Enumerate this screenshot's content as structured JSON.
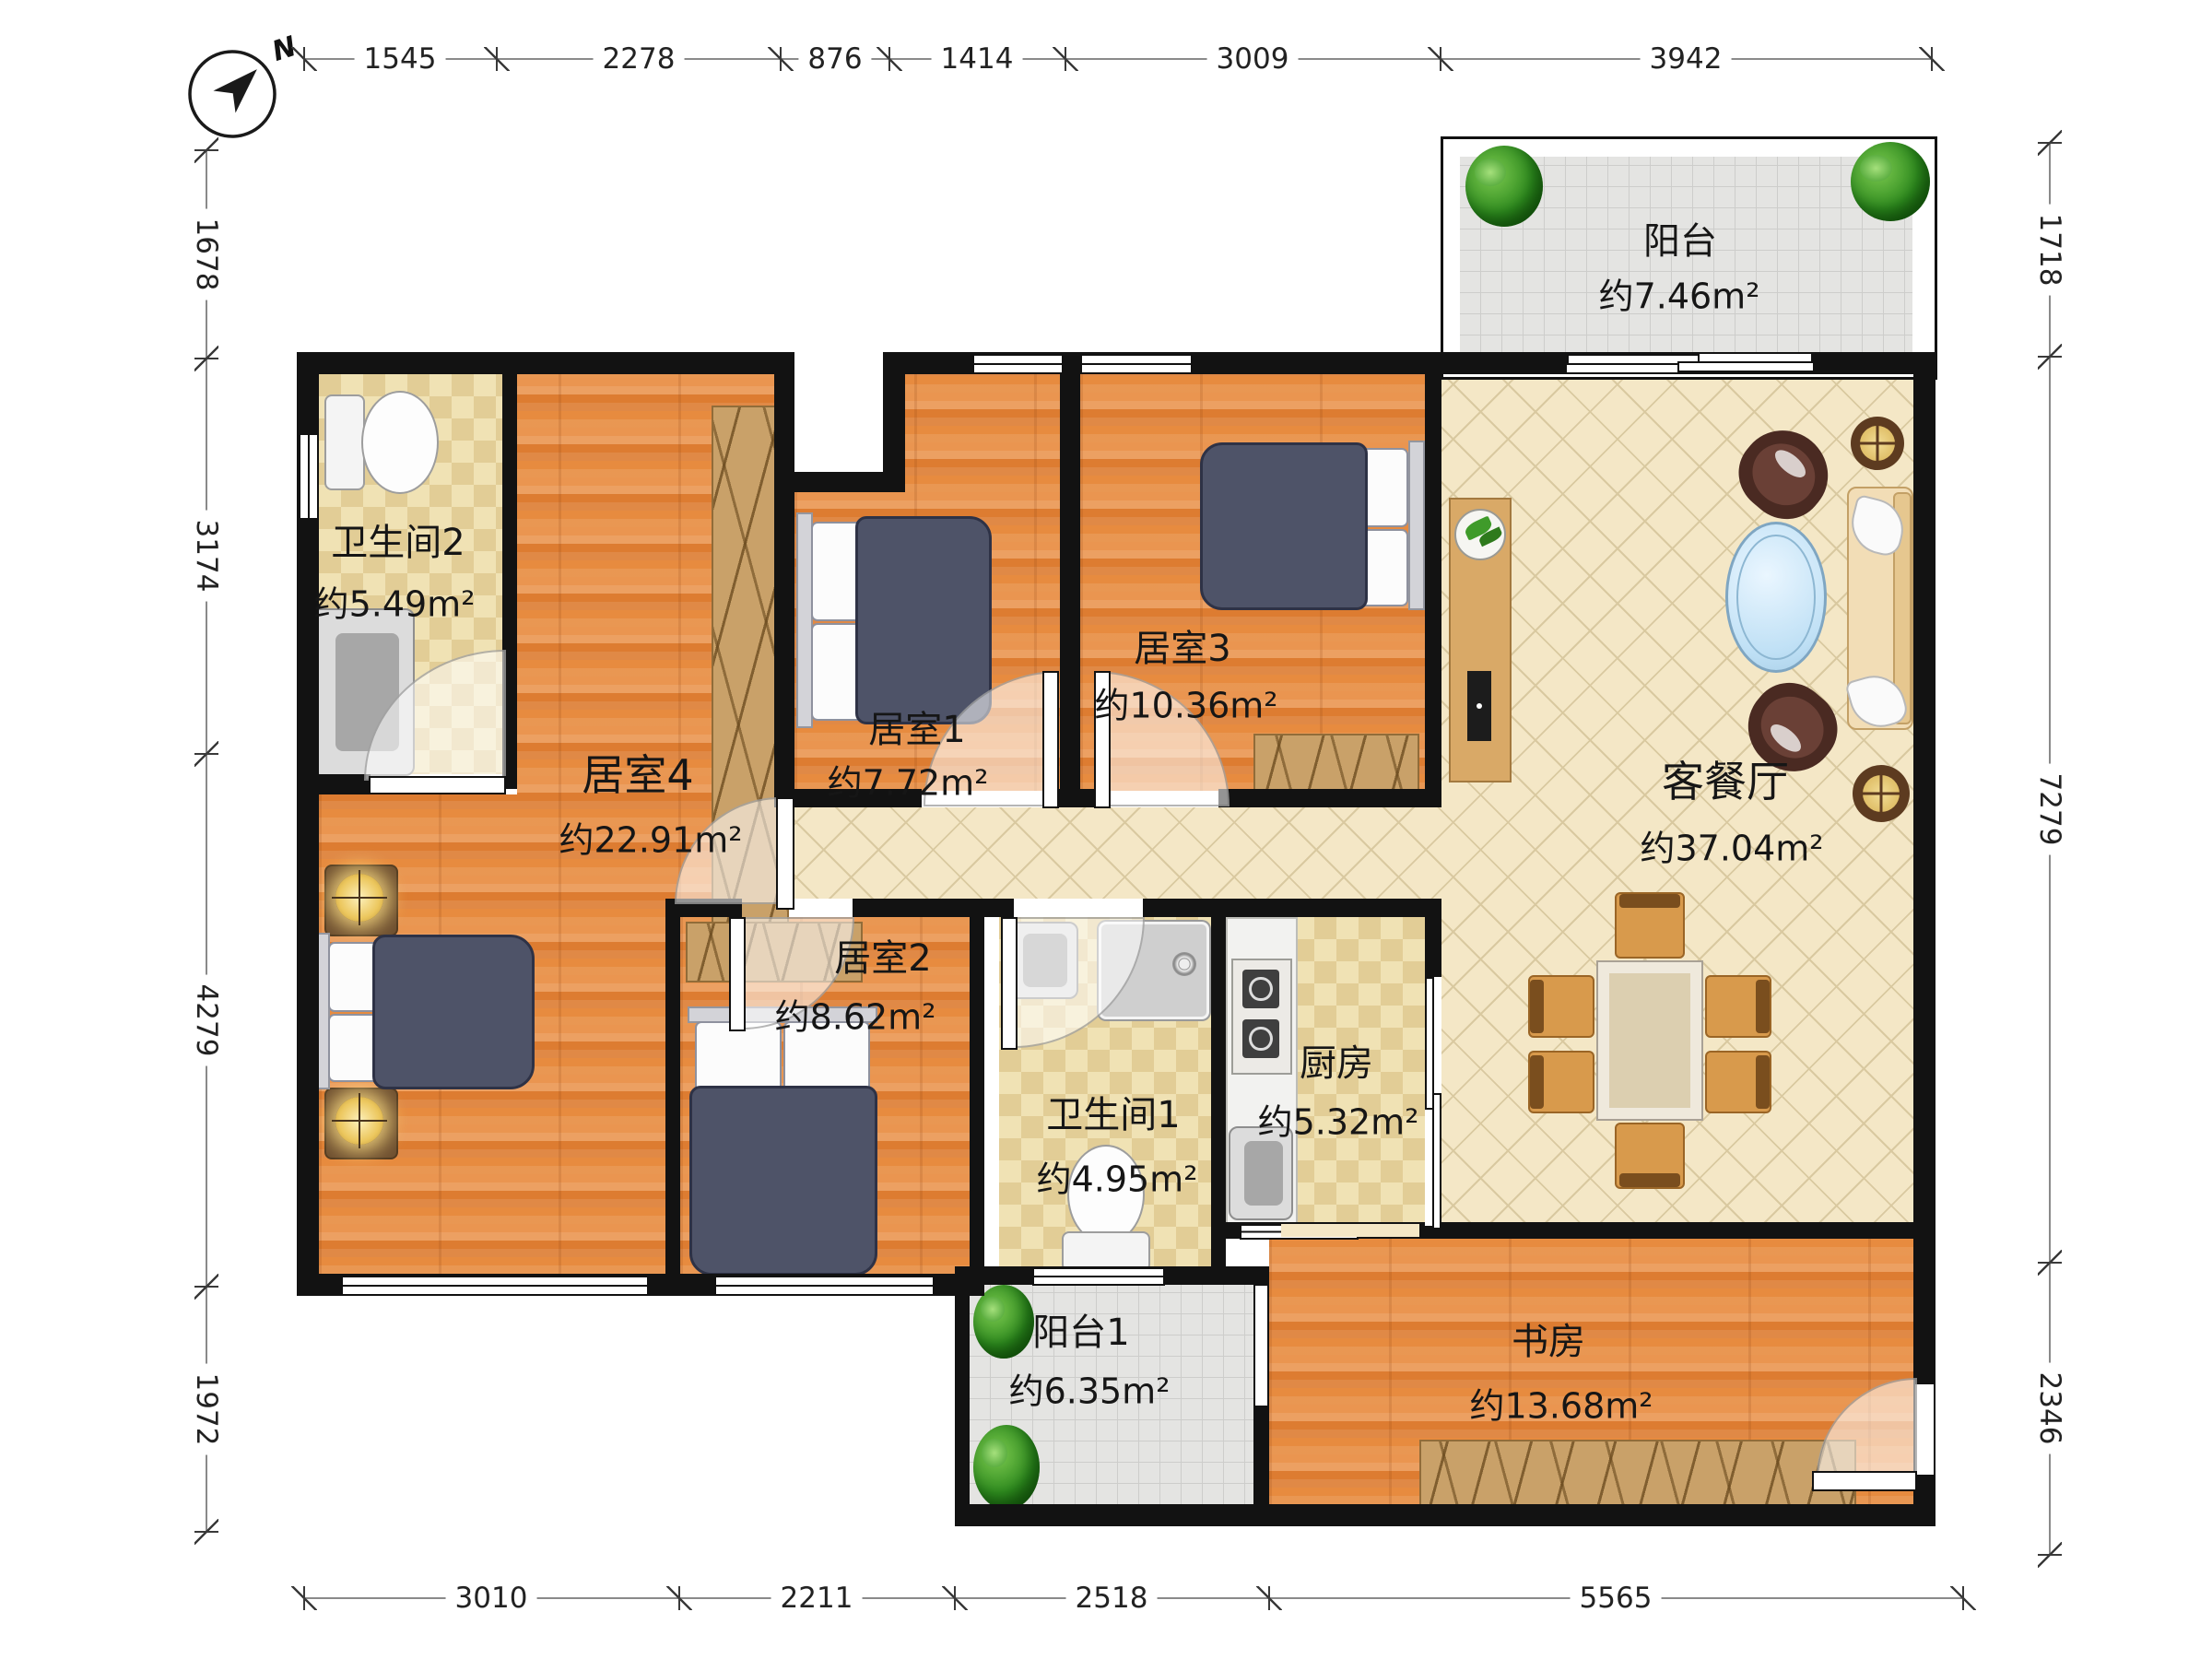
{
  "title": "apartment-floor-plan",
  "compass": {
    "north_label": "N"
  },
  "dimensions": {
    "top": [
      "1545",
      "2278",
      "876",
      "1414",
      "3009",
      "3942"
    ],
    "bottom": [
      "3010",
      "2211",
      "2518",
      "5565"
    ],
    "left": [
      "1678",
      "3174",
      "4279",
      "1972"
    ],
    "right": [
      "1718",
      "7279",
      "2346"
    ]
  },
  "rooms": {
    "balcony_top": {
      "name": "阳台",
      "area": "约7.46m²"
    },
    "bathroom2": {
      "name": "卫生间2",
      "area": "约5.49m²"
    },
    "bedroom4": {
      "name": "居室4",
      "area": "约22.91m²"
    },
    "bedroom1": {
      "name": "居室1",
      "area": "约7.72m²"
    },
    "bedroom3": {
      "name": "居室3",
      "area": "约10.36m²"
    },
    "living": {
      "name": "客餐厅",
      "area": "约37.04m²"
    },
    "bedroom2": {
      "name": "居室2",
      "area": "约8.62m²"
    },
    "bathroom1": {
      "name": "卫生间1",
      "area": "约4.95m²"
    },
    "kitchen": {
      "name": "厨房",
      "area": "约5.32m²"
    },
    "balcony1": {
      "name": "阳台1",
      "area": "约6.35m²"
    },
    "study": {
      "name": "书房",
      "area": "约13.68m²"
    }
  },
  "colors": {
    "wall": "#121212",
    "wood_floor": "#e2833c",
    "tile_floor": "#ead9a8",
    "living_floor": "#f4e7c6",
    "balcony_floor": "#e4e4e2",
    "bed": "#4e5368",
    "wardrobe": "#c9a169",
    "dimension_text": "#222222"
  },
  "icons": {
    "compass": "north-arrow-icon",
    "plants": "potted-plant-icon",
    "lamps": "glowing-lamp-icon"
  }
}
